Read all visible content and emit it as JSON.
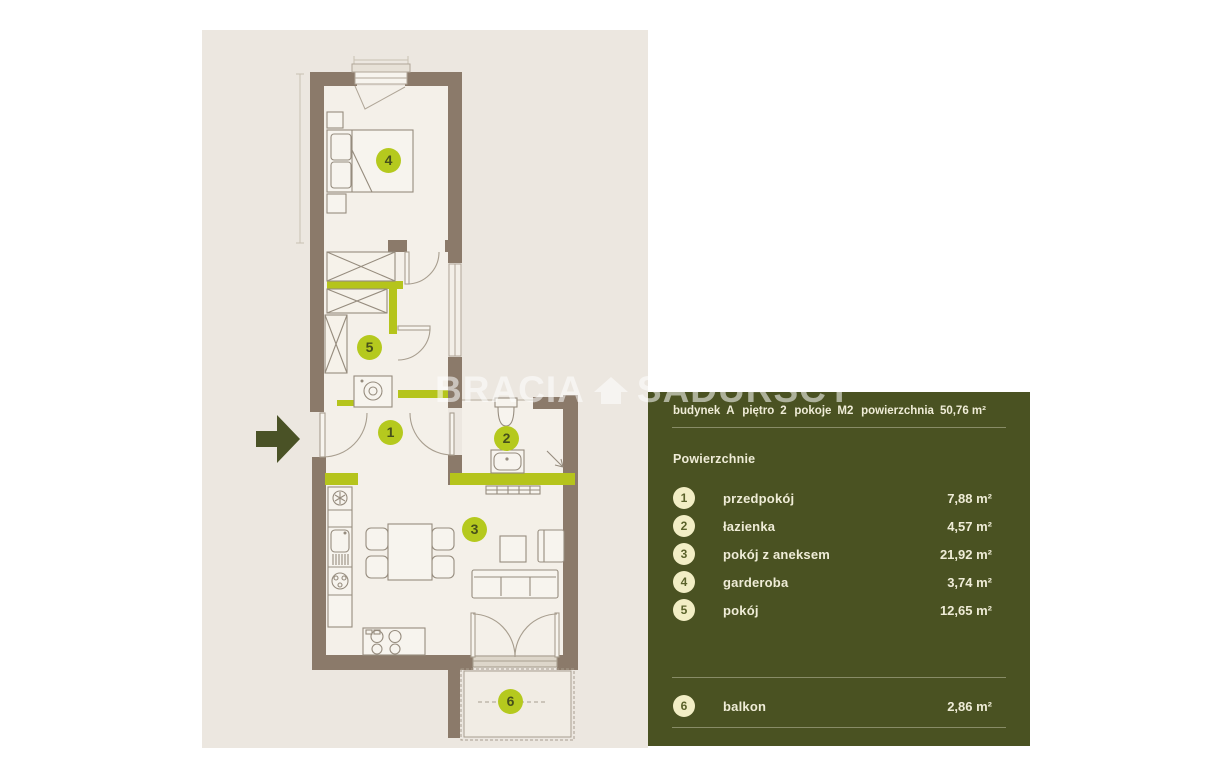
{
  "watermark": {
    "left": "BRACIA",
    "right": "SADURSCY"
  },
  "panel": {
    "header": [
      {
        "label": "budynek",
        "value": "A"
      },
      {
        "label": "piętro",
        "value": "2"
      },
      {
        "label": "pokoje",
        "value": "M2"
      },
      {
        "label": "powierzchnia",
        "value": "50,76 m²"
      }
    ],
    "section_title": "Powierzchnie",
    "rooms": [
      {
        "num": "1",
        "name": "przedpokój",
        "area": "7,88 m²"
      },
      {
        "num": "2",
        "name": "łazienka",
        "area": "4,57 m²"
      },
      {
        "num": "3",
        "name": "pokój z aneksem",
        "area": "21,92 m²"
      },
      {
        "num": "4",
        "name": "garderoba",
        "area": "3,74 m²"
      },
      {
        "num": "5",
        "name": "pokój",
        "area": "12,65 m²"
      }
    ],
    "extra": [
      {
        "num": "6",
        "name": "balkon",
        "area": "2,86 m²"
      }
    ]
  },
  "plan": {
    "labels": [
      {
        "num": "1"
      },
      {
        "num": "2"
      },
      {
        "num": "3"
      },
      {
        "num": "4"
      },
      {
        "num": "5"
      },
      {
        "num": "6"
      }
    ]
  },
  "colors": {
    "accent_green": "#b5c41c",
    "panel_bg": "#4a5222",
    "wall_brown": "#8b7a6a",
    "plan_bg": "#ece7e0",
    "panel_text": "#efecd7",
    "badge_plan_bg": "#b5c91e",
    "badge_panel_bg": "#f2eec5",
    "entry_arrow": "#4a5226"
  }
}
